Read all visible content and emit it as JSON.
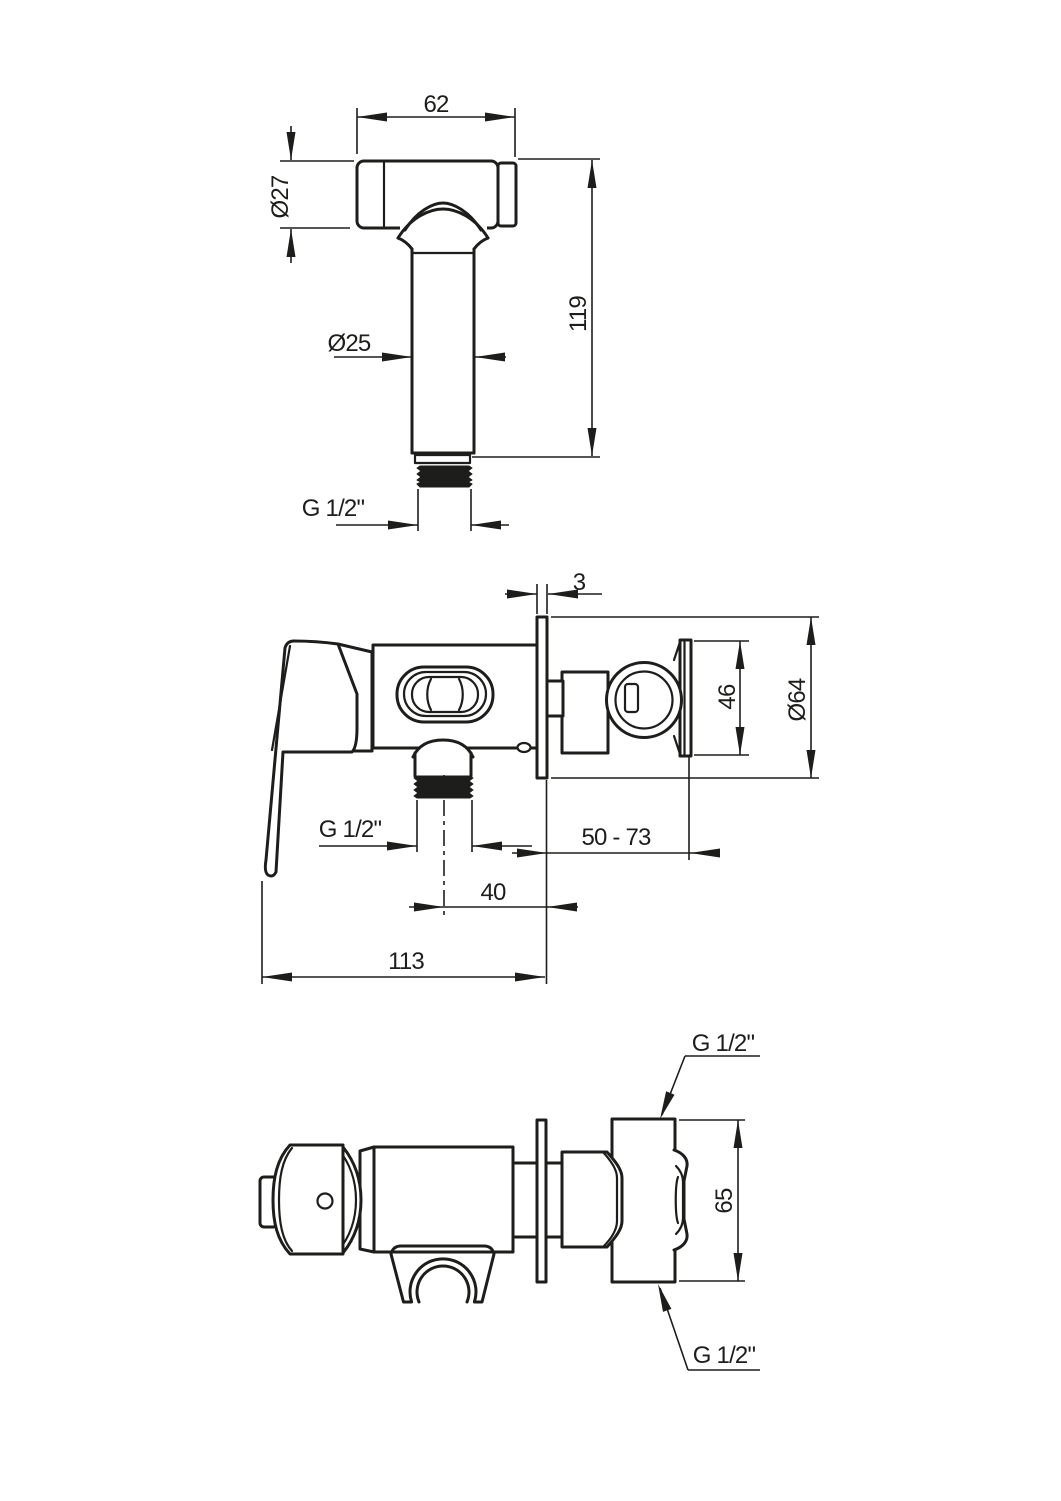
{
  "drawing": {
    "title": "bidet hand sprayer and concealed mixer - dimensional drawing",
    "background": "#ffffff",
    "line_color": "#1d1d1b",
    "views": {
      "sprayer_front": {
        "name": "hand sprayer front view",
        "dims": {
          "head_width": "62",
          "head_diameter": "Ø27",
          "handle_diameter": "Ø25",
          "height": "119",
          "thread": "G 1/2\""
        }
      },
      "mixer_side": {
        "name": "mixer side view",
        "dims": {
          "plate_thickness": "3",
          "holder_height": "46",
          "plate_diameter": "Ø64",
          "thread": "G 1/2\"",
          "wall_depth": "50 - 73",
          "outlet_offset": "40",
          "length": "113"
        }
      },
      "mixer_plan": {
        "name": "mixer plan view",
        "dims": {
          "body_height": "65",
          "thread_top": "G 1/2\"",
          "thread_bottom": "G 1/2\""
        }
      }
    }
  }
}
